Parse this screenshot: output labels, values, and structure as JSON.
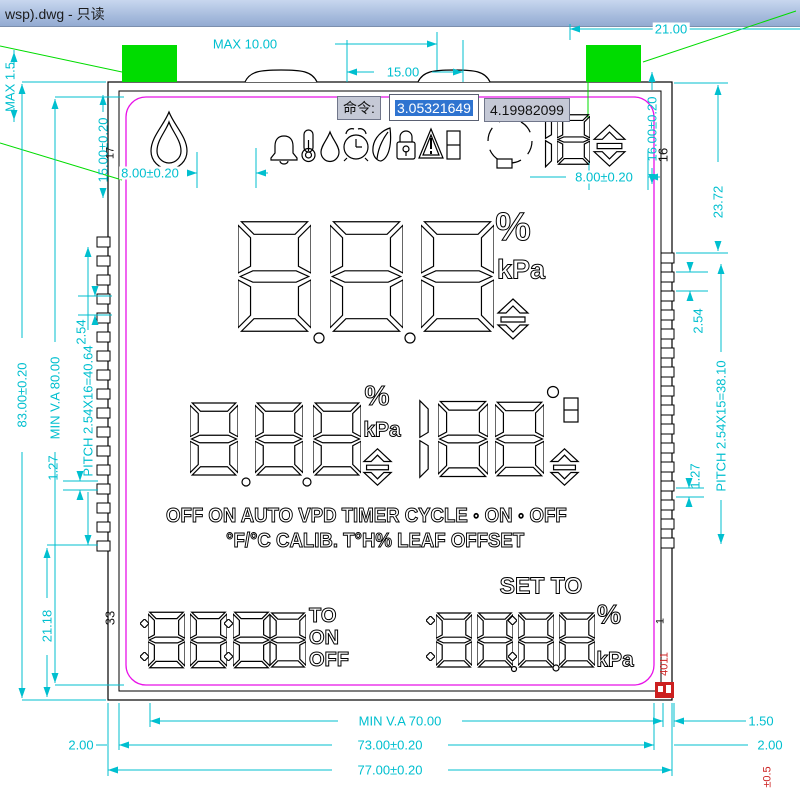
{
  "window": {
    "title": "wsp).dwg - 只读"
  },
  "command_bar": {
    "label": "命令:",
    "value_selected": "3.05321649",
    "value_secondary": "4.19982099"
  },
  "lcd": {
    "icons": [
      "droplet-icon",
      "bell-icon",
      "thermometer-icon",
      "water-drop-icon",
      "alarm-clock-icon",
      "leaf-icon",
      "lock-icon",
      "warning-icon",
      "battery-icon",
      "fan-cycle-icon",
      "updown-arrow-icon"
    ],
    "mode_line1": "OFF ON AUTO VPD TIMER CYCLE ◦ ON ◦ OFF",
    "mode_line2": "°F/°C CALIB. T°H% LEAF OFFSET",
    "set_to_label": "SET TO",
    "percent_main": "%",
    "kpa_main": "kPa",
    "percent_mid": "%",
    "kpa_mid": "kPa",
    "degree": "°",
    "percent_set": "%",
    "kpa_set": "kPa",
    "to_label": "TO",
    "on_label": "ON",
    "off_label": "OFF"
  },
  "pins": {
    "top_left": "17",
    "top_right": "16",
    "bottom_left": "33",
    "bottom_right": "1"
  },
  "stamp": {
    "code": "4011",
    "tolerance": "±0.5"
  },
  "dimensions": {
    "top_max": "MAX 10.00",
    "top_15": "15.00",
    "top_21": "21.00",
    "left_max": "MAX 1.5",
    "left_tab_v": "15.00±0.20",
    "right_tab_v": "16.00±0.20",
    "left_8": "8.00±0.20",
    "right_8": "8.00±0.20",
    "left_83": "83.00±0.20",
    "left_min_va": "MIN V.A 80.00",
    "left_pitch": "PITCH 2.54X16=40.64",
    "left_254": "2.54",
    "left_127": "1.27",
    "left_2118": "21.18",
    "right_2372": "23.72",
    "right_254": "2.54",
    "right_pitch": "PITCH 2.54X15=38.10",
    "right_127": "1.27",
    "bottom_min_va": "MIN V.A 70.00",
    "bottom_150": "1.50",
    "bottom_200_left": "2.00",
    "bottom_73": "73.00±0.20",
    "bottom_200_right": "2.00",
    "bottom_77": "77.00±0.20"
  },
  "colors": {
    "dimension": "#00bfcf",
    "outline": "#000000",
    "seal": "#e812e8",
    "tab": "#00dc00",
    "alert": "#cc2020"
  }
}
